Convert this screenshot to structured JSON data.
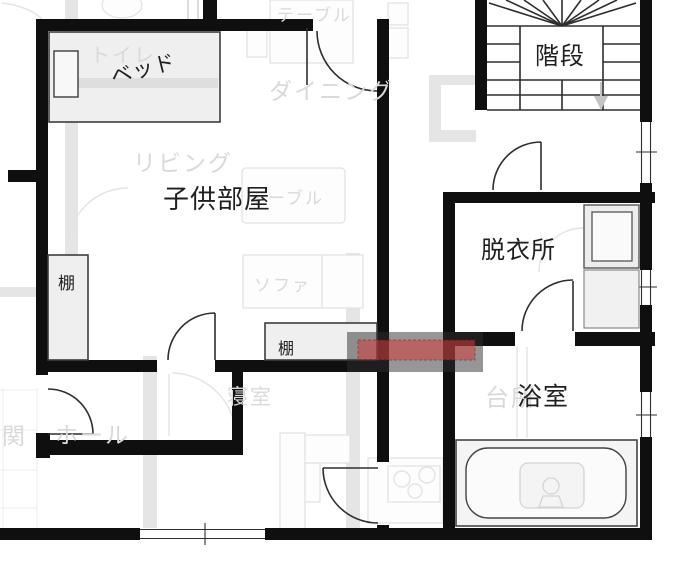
{
  "labels": {
    "children_room": "子供部屋",
    "stairs": "階段",
    "dressing_room": "脱衣所",
    "bathroom": "浴室",
    "bed": "ベッド",
    "shelf_left": "棚",
    "shelf_bottom": "棚",
    "toilet": "トイレ",
    "living": "リビング",
    "dining": "ダイニング",
    "table_top": "テーブル",
    "table_mid": "テーブル",
    "sofa": "ソファ",
    "bedroom": "寝室",
    "kitchen": "台所",
    "hall": "ホール",
    "entrance": "関"
  },
  "colors": {
    "wall": "#0f0f0f",
    "faded_plan": "#e3e3e3",
    "highlight_red": "#d23c3c",
    "highlight_gray": "#2d2d2d",
    "stair_arrow": "#c4c4c4"
  }
}
